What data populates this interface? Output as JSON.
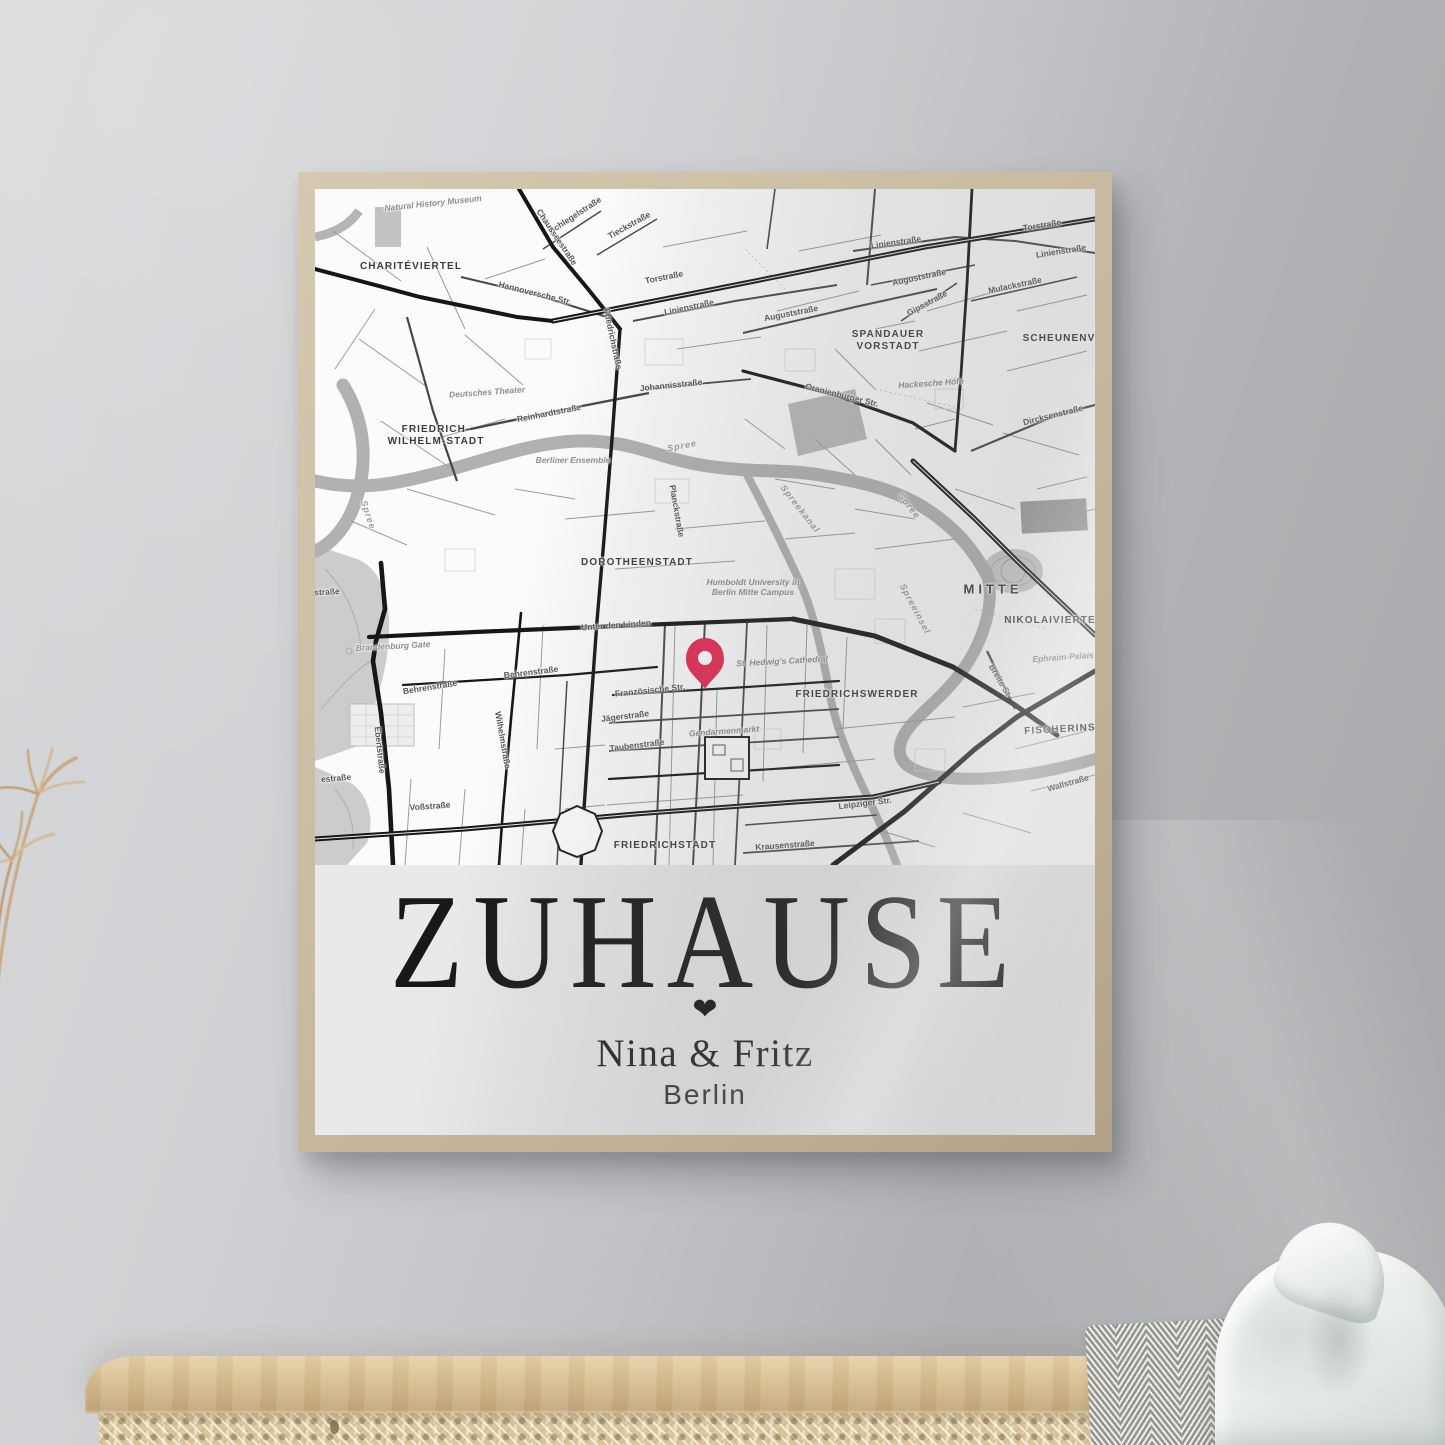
{
  "scene": {
    "wall_color": "#c9cbce",
    "frame_color": "#c9bba2",
    "sideboard_wood_color": "#d6c097",
    "cane_color": "#e4d4b2",
    "cloth_color": "#edf0ef",
    "blanket_stripe_colors": [
      "#f0f0ed",
      "#96968f"
    ],
    "plant_color": "#c9a478"
  },
  "poster": {
    "title": "ZUHAUSE",
    "heart_icon": "❤",
    "names": "Nina & Fritz",
    "city": "Berlin",
    "pin_color": "#e5294e",
    "map": {
      "pin": {
        "x": 390,
        "y": 500
      },
      "labels": [
        {
          "text": "Natural History Museum",
          "type": "p",
          "x": 118,
          "y": 14,
          "rot": -6
        },
        {
          "text": "CHARITÉVIERTEL",
          "type": "d",
          "x": 96,
          "y": 78,
          "rot": 0
        },
        {
          "text": "Schlegelstraße",
          "type": "s",
          "x": 260,
          "y": 26,
          "rot": -33
        },
        {
          "text": "Tieckstraße",
          "type": "s",
          "x": 314,
          "y": 36,
          "rot": -29
        },
        {
          "text": "Chausseestraße",
          "type": "s",
          "x": 242,
          "y": 48,
          "rot": 56
        },
        {
          "text": "Hannoversche Str.",
          "type": "s",
          "x": 220,
          "y": 104,
          "rot": 14
        },
        {
          "text": "Torstraße",
          "type": "s",
          "x": 349,
          "y": 88,
          "rot": -11
        },
        {
          "text": "Torstraße",
          "type": "s",
          "x": 727,
          "y": 36,
          "rot": -9
        },
        {
          "text": "Linienstraße",
          "type": "s",
          "x": 374,
          "y": 118,
          "rot": -12
        },
        {
          "text": "Linienstraße",
          "type": "s",
          "x": 581,
          "y": 53,
          "rot": -8
        },
        {
          "text": "Linienstraße",
          "type": "s",
          "x": 746,
          "y": 62,
          "rot": -9
        },
        {
          "text": "Friedrichstraße",
          "type": "s",
          "x": 298,
          "y": 150,
          "rot": 78
        },
        {
          "text": "Johannisstraße",
          "type": "s",
          "x": 356,
          "y": 196,
          "rot": -6
        },
        {
          "text": "Auguststraße",
          "type": "s",
          "x": 476,
          "y": 124,
          "rot": -11
        },
        {
          "text": "Auguststraße",
          "type": "s",
          "x": 604,
          "y": 88,
          "rot": -12
        },
        {
          "text": "Gipsstraße",
          "type": "s",
          "x": 612,
          "y": 114,
          "rot": -28
        },
        {
          "text": "Mulackstraße",
          "type": "s",
          "x": 700,
          "y": 96,
          "rot": -12
        },
        {
          "text": "SPANDAUER\nVORSTADT",
          "type": "d",
          "x": 573,
          "y": 152,
          "rot": 0
        },
        {
          "text": "SCHEUNENV",
          "type": "d",
          "x": 744,
          "y": 150,
          "rot": 0
        },
        {
          "text": "Hackesche Höfe",
          "type": "p",
          "x": 616,
          "y": 194,
          "rot": -4
        },
        {
          "text": "Oranienburger Str.",
          "type": "s",
          "x": 527,
          "y": 206,
          "rot": 14
        },
        {
          "text": "Dircksenstraße",
          "type": "s",
          "x": 738,
          "y": 226,
          "rot": -14
        },
        {
          "text": "Deutsches Theater",
          "type": "p",
          "x": 172,
          "y": 203,
          "rot": -4
        },
        {
          "text": "Reinhardtstraße",
          "type": "s",
          "x": 234,
          "y": 224,
          "rot": -11
        },
        {
          "text": "FRIEDRICH-\nWILHELM-STADT",
          "type": "d",
          "x": 121,
          "y": 247,
          "rot": 0
        },
        {
          "text": "Berliner Ensemble",
          "type": "p",
          "x": 258,
          "y": 271,
          "rot": 0
        },
        {
          "text": "Spree",
          "type": "w",
          "x": 367,
          "y": 257,
          "rot": -11
        },
        {
          "text": "Spree",
          "type": "w",
          "x": 53,
          "y": 326,
          "rot": 72
        },
        {
          "text": "Spree",
          "type": "w",
          "x": 594,
          "y": 317,
          "rot": 52
        },
        {
          "text": "Spreekanal",
          "type": "w",
          "x": 485,
          "y": 320,
          "rot": 52
        },
        {
          "text": "Planckstraße",
          "type": "s",
          "x": 362,
          "y": 322,
          "rot": 80
        },
        {
          "text": "DOROTHEENSTADT",
          "type": "d",
          "x": 322,
          "y": 374,
          "rot": 0
        },
        {
          "text": "Humboldt University in\nBerlin Mitte Campus",
          "type": "p",
          "x": 438,
          "y": 398,
          "rot": 0
        },
        {
          "text": "MITTE",
          "type": "d",
          "x": 678,
          "y": 400,
          "rot": 0,
          "size": 13,
          "ls": 4
        },
        {
          "text": "Unter den Linden",
          "type": "s",
          "x": 301,
          "y": 436,
          "rot": -4
        },
        {
          "text": "Brandenburg Gate",
          "type": "p",
          "x": 78,
          "y": 457,
          "rot": -3
        },
        {
          "text": "enstraße",
          "type": "s",
          "x": 7,
          "y": 403,
          "rot": -3
        },
        {
          "text": "Behrenstraße",
          "type": "s",
          "x": 115,
          "y": 498,
          "rot": -9
        },
        {
          "text": "Behrenstraße",
          "type": "s",
          "x": 216,
          "y": 483,
          "rot": -7
        },
        {
          "text": "Französische Str.",
          "type": "s",
          "x": 335,
          "y": 501,
          "rot": -6
        },
        {
          "text": "St. Hedwig's Cathedral",
          "type": "p",
          "x": 467,
          "y": 472,
          "rot": -3
        },
        {
          "text": "FRIEDRICHSWERDER",
          "type": "d",
          "x": 542,
          "y": 506,
          "rot": 0
        },
        {
          "text": "NIKOLAIVIERTE",
          "type": "d",
          "x": 735,
          "y": 432,
          "rot": 0
        },
        {
          "text": "Spreeinsel",
          "type": "w",
          "x": 600,
          "y": 420,
          "rot": 62
        },
        {
          "text": "Ephraim-Palais",
          "type": "p",
          "x": 748,
          "y": 468,
          "rot": -4
        },
        {
          "text": "Breite St",
          "type": "s",
          "x": 685,
          "y": 491,
          "rot": 60
        },
        {
          "text": "Jägerstraße",
          "type": "s",
          "x": 310,
          "y": 527,
          "rot": -7
        },
        {
          "text": "Taubenstraße",
          "type": "s",
          "x": 322,
          "y": 556,
          "rot": -7
        },
        {
          "text": "Gendarmenmarkt",
          "type": "p",
          "x": 409,
          "y": 542,
          "rot": -4
        },
        {
          "text": "FISCHERINS",
          "type": "d",
          "x": 745,
          "y": 541,
          "rot": -3
        },
        {
          "text": "Ebertstraße",
          "type": "s",
          "x": 65,
          "y": 561,
          "rot": 84
        },
        {
          "text": "Wilhelmstraße",
          "type": "s",
          "x": 188,
          "y": 551,
          "rot": 80
        },
        {
          "text": "estraße",
          "type": "s",
          "x": 21,
          "y": 589,
          "rot": -5
        },
        {
          "text": "Voßstraße",
          "type": "s",
          "x": 115,
          "y": 617,
          "rot": -4
        },
        {
          "text": "Leipziger Str.",
          "type": "s",
          "x": 550,
          "y": 614,
          "rot": -7
        },
        {
          "text": "Wallstraße",
          "type": "s",
          "x": 753,
          "y": 594,
          "rot": -16
        },
        {
          "text": "Krausenstraße",
          "type": "s",
          "x": 470,
          "y": 656,
          "rot": -4
        },
        {
          "text": "FRIEDRICHSTADT",
          "type": "d",
          "x": 350,
          "y": 657,
          "rot": 0
        }
      ]
    }
  }
}
